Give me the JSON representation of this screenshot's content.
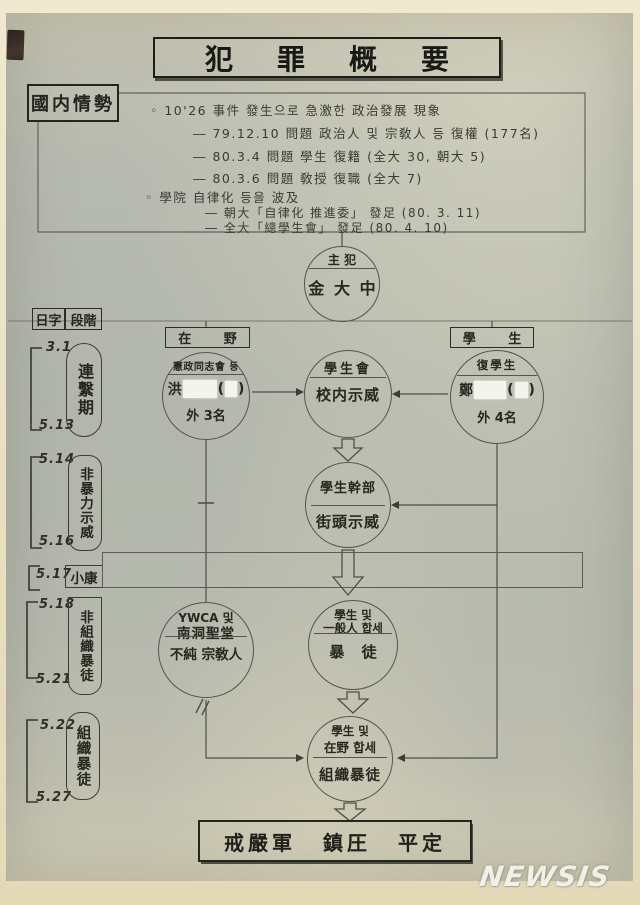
{
  "title": "犯罪概要",
  "situation": {
    "label": "國内情勢",
    "lines": [
      "◦ 10'26 事件  發生으로  急激한  政治發展  現象",
      "― 79.12.10 問題 政治人 및  宗敎人 등  復權 (177名)",
      "― 80.3.4  問題 學生  復籍 (全大 30,  朝大 5)",
      "― 80.3.6  問題  敎授 復職 (全大 7)",
      "◦ 學院 自律化  등을  波及",
      "― 朝大「自律化 推進委」 發足 (80. 3. 11)",
      "― 全大「總學生會」 發足  (80. 4. 10)"
    ]
  },
  "mastermind": {
    "role": "主 犯",
    "name": "金 大 中"
  },
  "columns": {
    "left": "在 野",
    "right": "學 生"
  },
  "header": {
    "date": "日字",
    "stage": "段階"
  },
  "timeline": {
    "dates": [
      "3.1",
      "5.13",
      "5.14",
      "5.16",
      "5.17",
      "5.18",
      "5.21",
      "5.22",
      "5.27"
    ],
    "stages": [
      "連繫期",
      "非暴力示威",
      "小康",
      "非組織暴徒",
      "組織暴徒"
    ]
  },
  "nodes": {
    "opposition": {
      "top": "憲政同志會 등",
      "name": "洪",
      "paren_open": "(",
      "paren_close": ")",
      "bottom": "外 3名"
    },
    "student_council": {
      "top": "學生會",
      "bottom": "校内示威"
    },
    "returned_students": {
      "top": "復學生",
      "name": "鄭",
      "paren_open": "(",
      "paren_close": ")",
      "bottom": "外 4名"
    },
    "student_cadre": {
      "top": "學生幹部",
      "bottom": "街頭示威"
    },
    "ywca": {
      "top1": "YWCA 및",
      "top2": "南洞聖堂",
      "bottom": "不純 宗敎人"
    },
    "mob": {
      "top1": "學生 및",
      "top2": "一般人 합세",
      "bottom": "暴 徒"
    },
    "organized_mob": {
      "top1": "學生 및",
      "top2": "在野 합세",
      "bottom": "組織暴徒"
    }
  },
  "conclusion": "戒嚴軍 鎮圧 平定",
  "watermark": "NEWSIS",
  "colors": {
    "paper": "#b5b8ad",
    "margin": "#eae2c4",
    "ink": "#30312b",
    "redaction": "#f4f4ee"
  }
}
